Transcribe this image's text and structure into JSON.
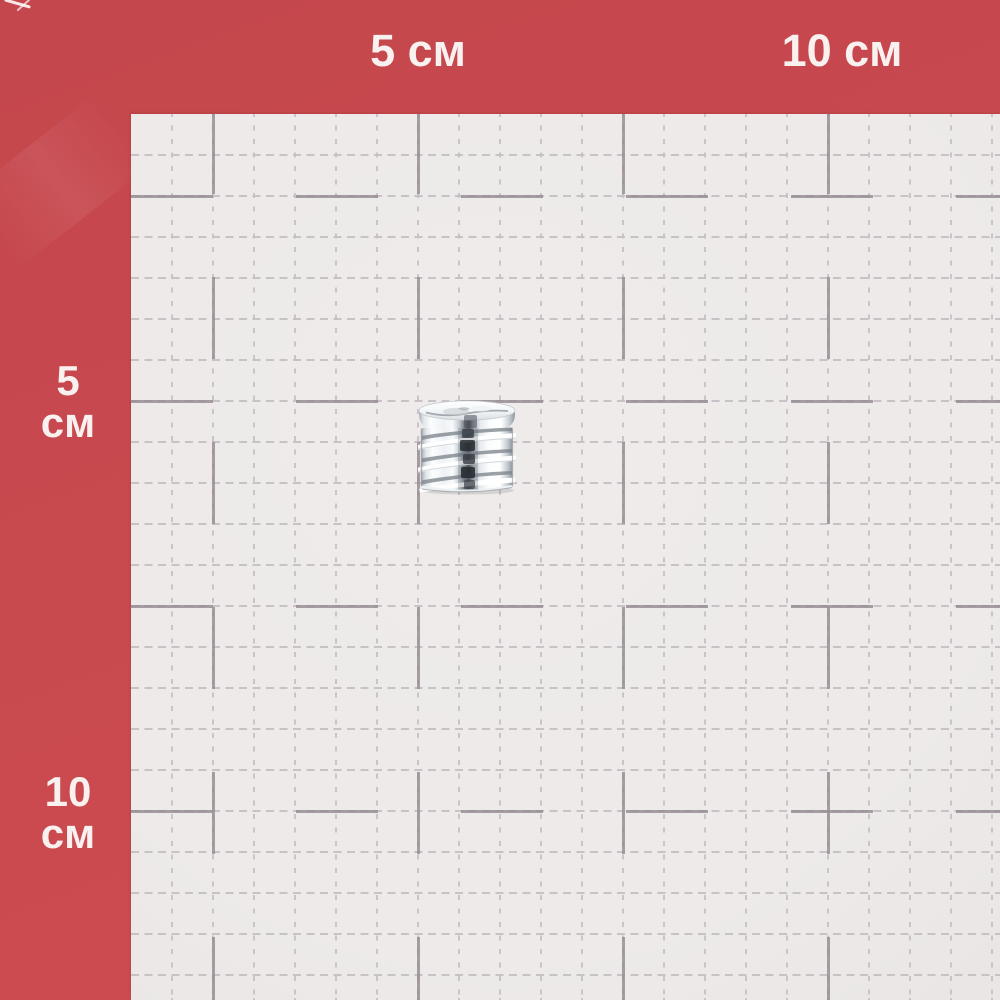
{
  "labels": {
    "top_5": "5 см",
    "top_10": "10 см",
    "left_5_value": "5",
    "left_5_unit": "см",
    "left_10_value": "10",
    "left_10_unit": "см"
  },
  "scale": {
    "unit": "см",
    "marked_values": [
      "5",
      "10"
    ]
  },
  "colors": {
    "background_red": "#c8494e",
    "paper": "#edeae9",
    "grid_light": "#c6bfc3",
    "grid_dark": "#988f94",
    "label_text": "#f8f1f0"
  }
}
